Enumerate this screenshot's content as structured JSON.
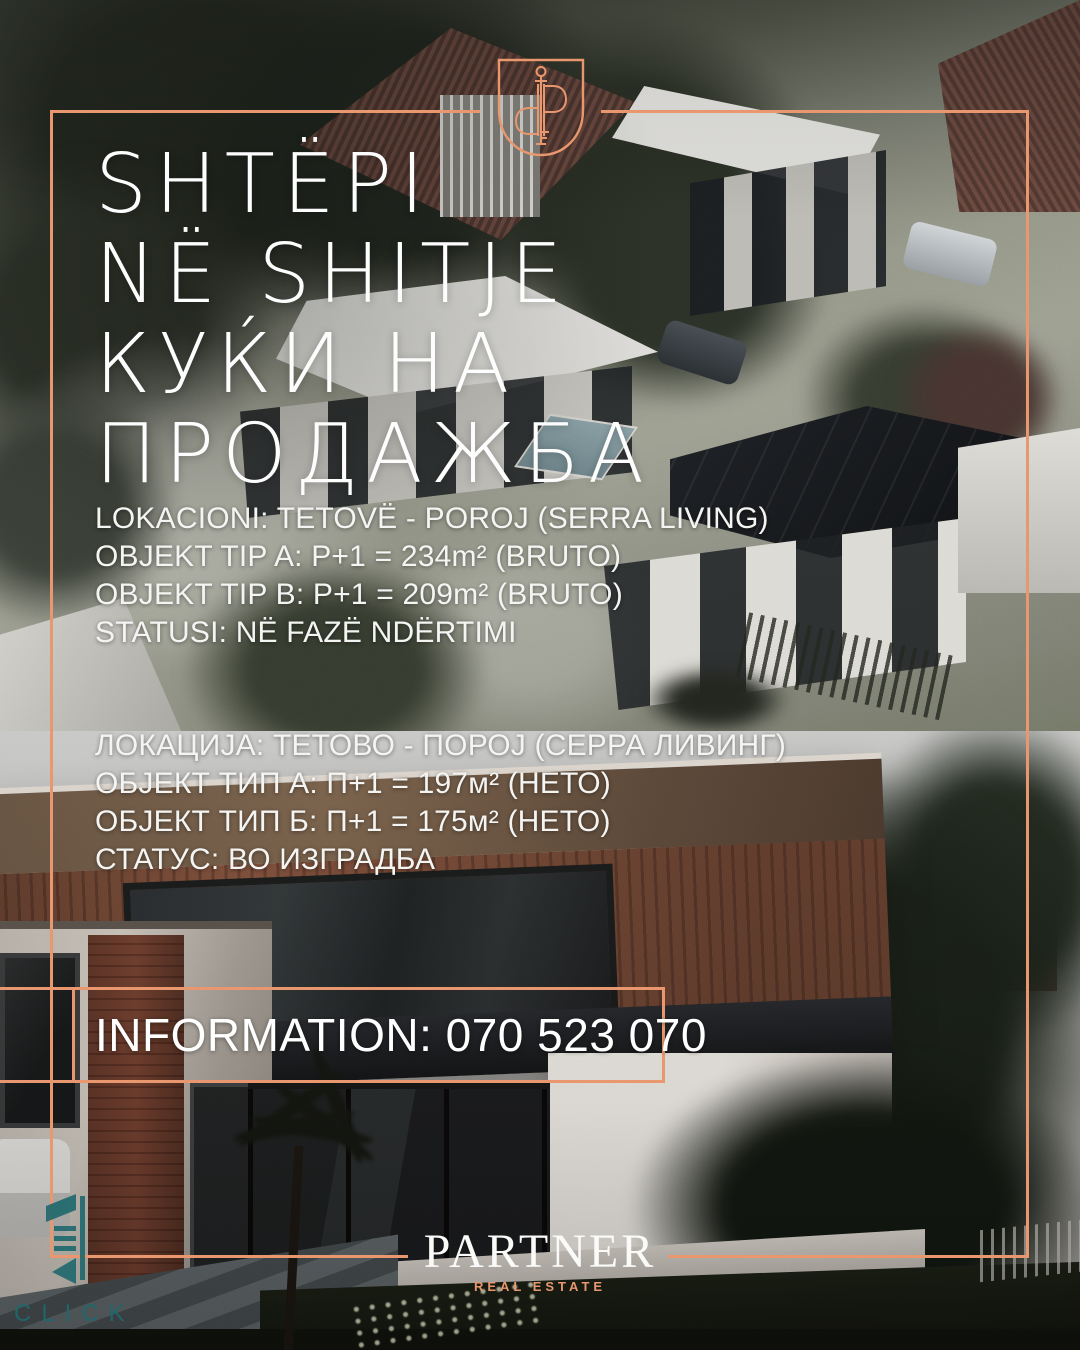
{
  "poster": {
    "accent_color": "#E8976E",
    "watermark_color": "#1E686D"
  },
  "icons": {
    "monogram": "pp-key-shield-monogram",
    "watermark_logo": "click-abstract-mark"
  },
  "headline": {
    "lines": [
      "SHTËPI",
      "NË SHITJE",
      "КУЌИ НА",
      "ПРОДАЖБА"
    ]
  },
  "details_sq": {
    "lines": [
      "LOKACIONI: TETOVË - POROJ (SERRA LIVING)",
      "OBJEKT TIP A: P+1 = 234m² (BRUTO)",
      "OBJEKT TIP B: P+1 = 209m² (BRUTO)",
      "STATUSI: NË FAZË NDËRTIMI"
    ]
  },
  "details_mk": {
    "lines": [
      "ЛОКАЦИЈА: ТЕТОВО - ПОРОЈ (СЕРРА ЛИВИНГ)",
      "ОБЈЕКТ ТИП А: П+1 = 197м² (НЕТО)",
      "ОБЈЕКТ ТИП Б: П+1 = 175м² (НЕТО)",
      "СТАТУС: ВО ИЗГРАДБА"
    ]
  },
  "contact": {
    "information": "INFORMATION: 070 523 070"
  },
  "brand": {
    "name": "PARTNER",
    "tagline": "REAL ESTATE"
  },
  "watermark": {
    "text": "CLICK"
  }
}
